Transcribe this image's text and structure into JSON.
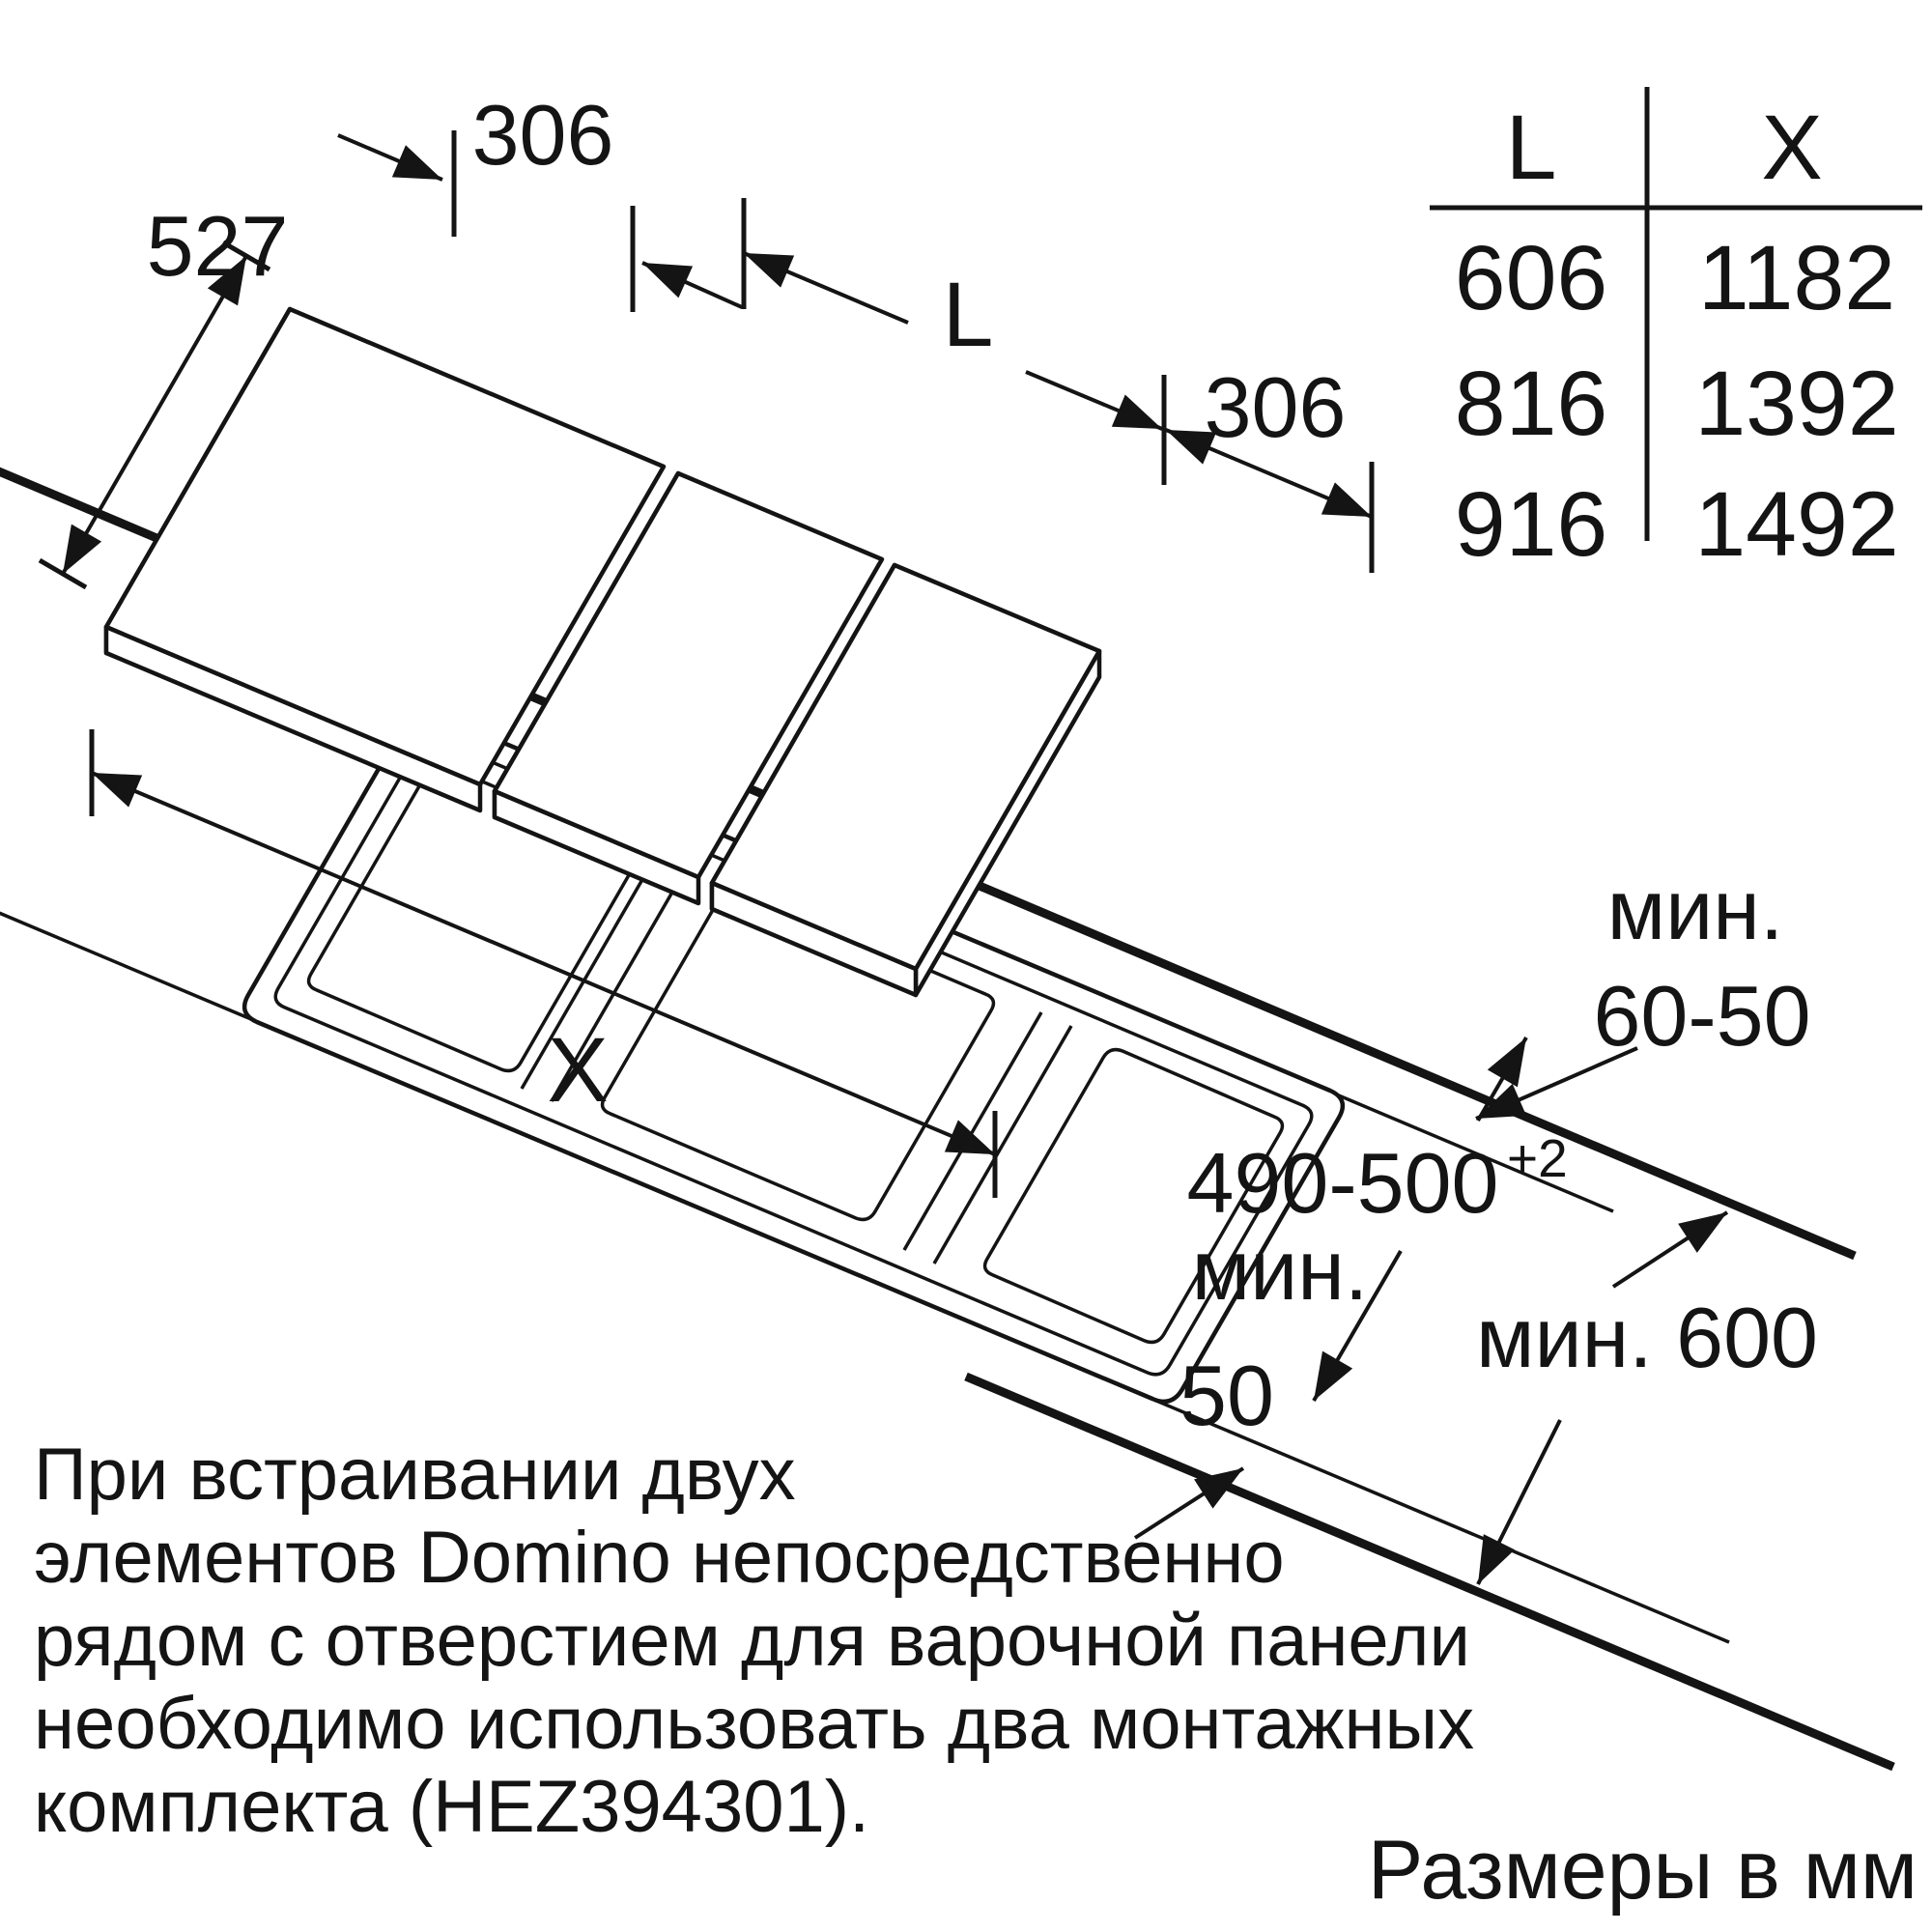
{
  "dimensions": {
    "panel_depth": "527",
    "panel_width_top": "306",
    "length_label": "L",
    "panel_width_right": "306",
    "cutout_width_label": "X",
    "min_back_word": "мин.",
    "back_clearance": "60-50",
    "cutout_depth": "490-500",
    "cutout_depth_tolerance": "+2",
    "min_front_word": "мин.",
    "front_clearance": "50",
    "worktop_depth": "мин. 600"
  },
  "table": {
    "columns": [
      "L",
      "X"
    ],
    "rows": [
      [
        "606",
        "1182"
      ],
      [
        "816",
        "1392"
      ],
      [
        "916",
        "1492"
      ]
    ]
  },
  "note": {
    "lines": [
      "При встраивании двух",
      "элементов Domino непосредственно",
      "рядом с отверстием для варочной панели",
      "необходимо использовать два монтажных",
      "комплекта (HEZ394301)."
    ]
  },
  "footer": {
    "units": "Размеры в мм"
  }
}
